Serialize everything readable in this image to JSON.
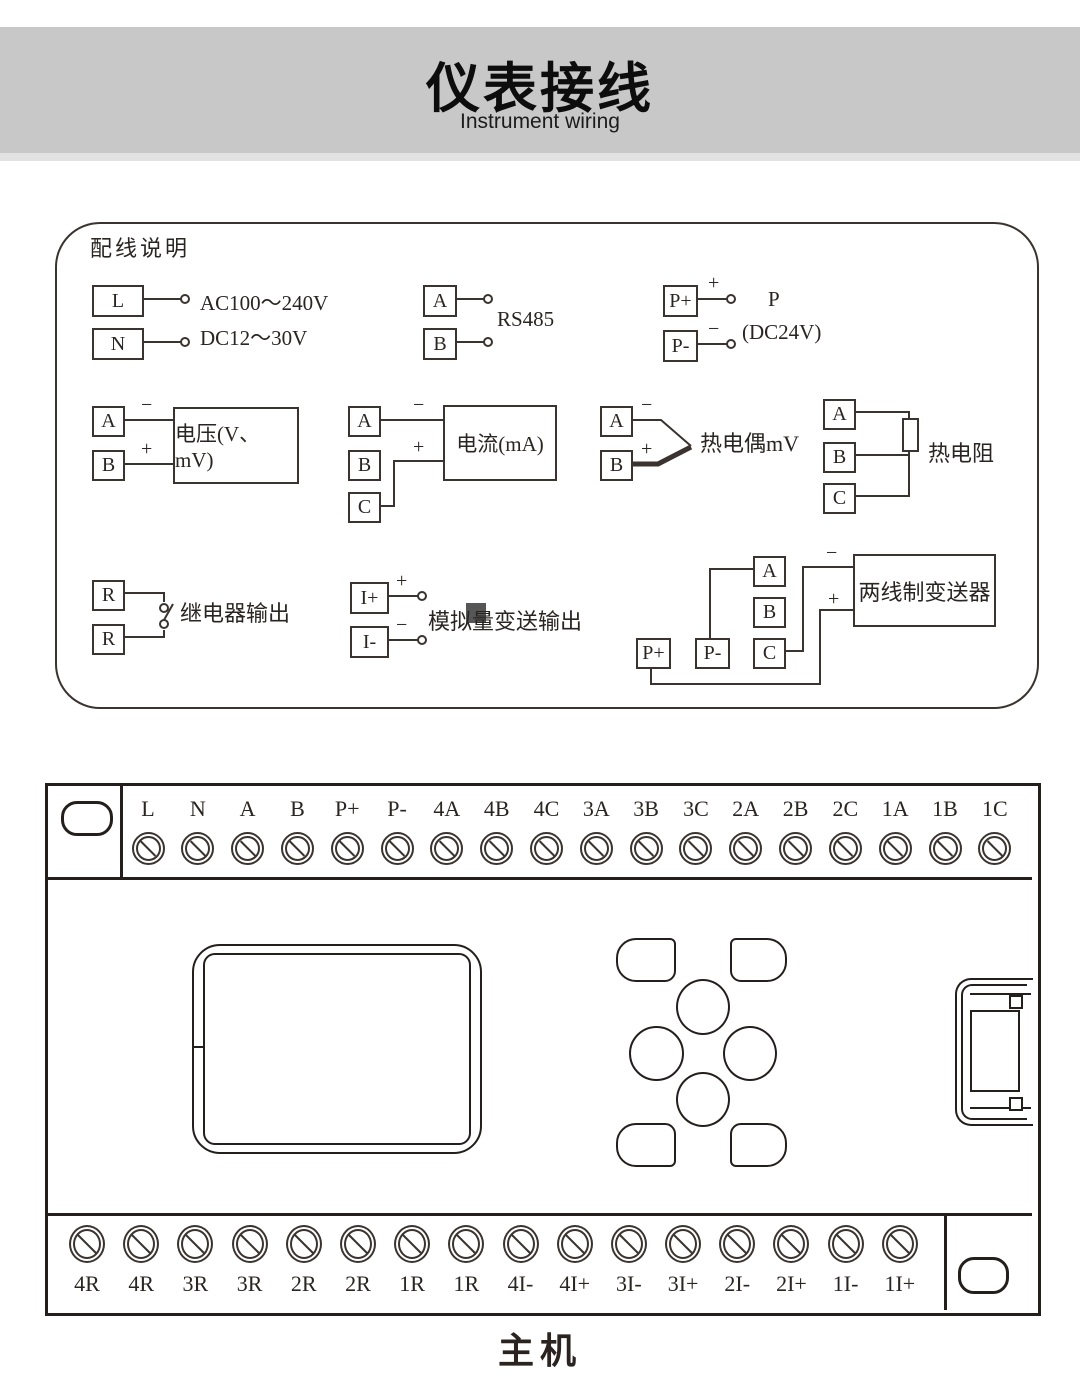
{
  "header": {
    "title": "仪表接线",
    "subtitle": "Instrument wiring"
  },
  "wiring": {
    "title": "配线说明",
    "power": {
      "t1": "L",
      "t2": "N",
      "line1": "AC100～240V",
      "line2": "DC12～30V"
    },
    "rs485": {
      "t1": "A",
      "t2": "B",
      "label": "RS485"
    },
    "pwr24": {
      "t1": "P+",
      "t2": "P-",
      "plus": "+",
      "minus": "−",
      "name": "P",
      "spec": "(DC24V)"
    },
    "voltage": {
      "t1": "A",
      "t2": "B",
      "minus": "−",
      "plus": "+",
      "label": "电压(V、mV)"
    },
    "current": {
      "t1": "A",
      "t2": "B",
      "t3": "C",
      "minus": "−",
      "plus": "+",
      "label": "电流(mA)"
    },
    "thermocouple": {
      "t1": "A",
      "t2": "B",
      "minus": "−",
      "plus": "+",
      "label": "热电偶mV"
    },
    "rtd": {
      "t1": "A",
      "t2": "B",
      "t3": "C",
      "label": "热电阻"
    },
    "relay": {
      "t1": "R",
      "t2": "R",
      "label": "继电器输出"
    },
    "analog": {
      "t1": "I+",
      "t2": "I-",
      "plus": "+",
      "minus": "−",
      "label": "模拟量变送输出"
    },
    "transmitter": {
      "tA": "A",
      "tB": "B",
      "tC": "C",
      "tP1": "P+",
      "tP2": "P-",
      "minus": "−",
      "plus": "+",
      "label": "两线制变送器"
    }
  },
  "device": {
    "top_terminals": [
      "L",
      "N",
      "A",
      "B",
      "P+",
      "P-",
      "4A",
      "4B",
      "4C",
      "3A",
      "3B",
      "3C",
      "2A",
      "2B",
      "2C",
      "1A",
      "1B",
      "1C"
    ],
    "bottom_terminals": [
      "4R",
      "4R",
      "3R",
      "3R",
      "2R",
      "2R",
      "1R",
      "1R",
      "4I-",
      "4I+",
      "3I-",
      "3I+",
      "2I-",
      "2I+",
      "1I-",
      "1I+"
    ],
    "caption": "主机"
  }
}
